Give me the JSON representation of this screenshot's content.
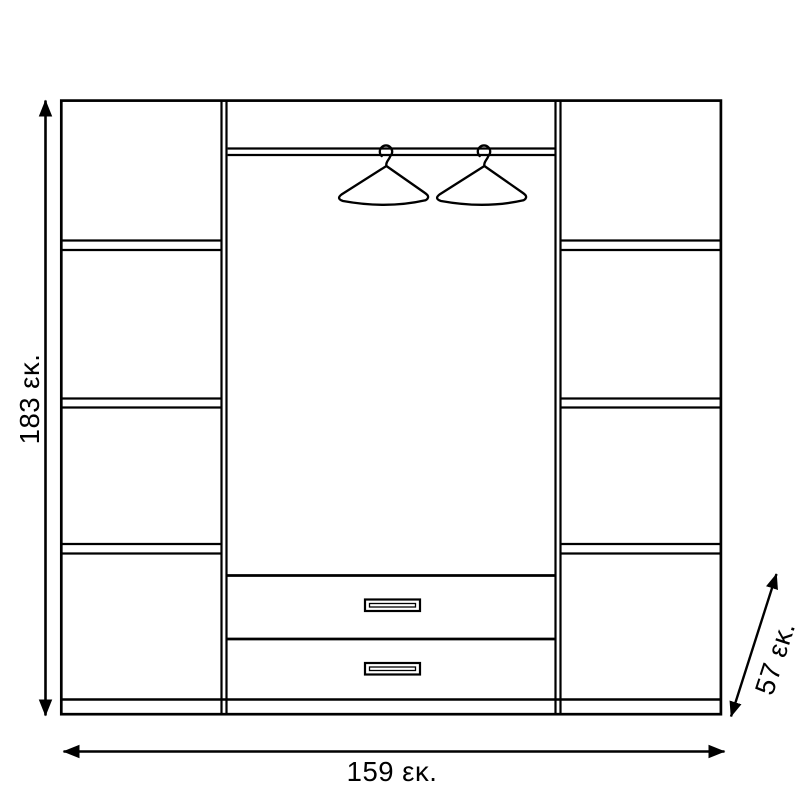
{
  "page": {
    "background_color": "#ffffff",
    "line_color": "#000000"
  },
  "diagram": {
    "kind": "wardrobe-technical-drawing",
    "dimensions": {
      "height": {
        "value": "183",
        "unit": "εκ.",
        "label": "183 εκ."
      },
      "width": {
        "value": "159",
        "unit": "εκ.",
        "label": "159 εκ."
      },
      "depth": {
        "value": "57",
        "unit": "εκ.",
        "label": "57 εκ."
      }
    },
    "features": {
      "left_column_compartments": 4,
      "right_column_compartments": 4,
      "drawers": 2,
      "hangers": 2,
      "icons": [
        "hanger-icon",
        "dimension-arrow-icon"
      ]
    }
  }
}
